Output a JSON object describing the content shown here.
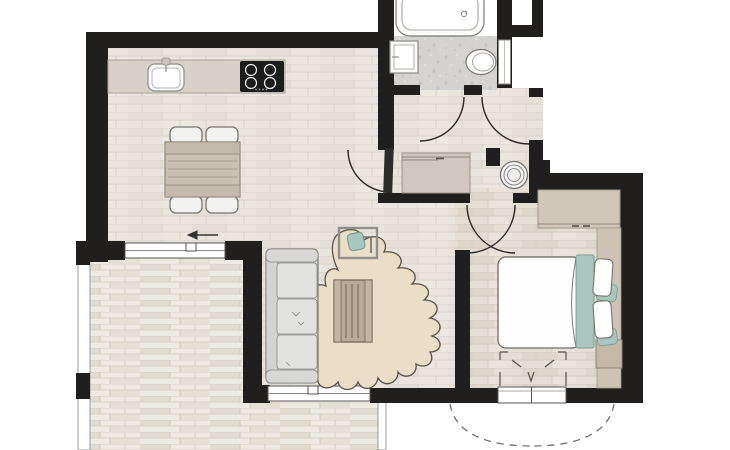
{
  "canvas": {
    "width": 730,
    "height": 450,
    "background": "#ffffff"
  },
  "colors": {
    "wall": "#211f1d",
    "floor_wood_main": "#e9e5de",
    "floor_wood_bedroom": "#e4ded4",
    "floor_balcony": "#edeae3",
    "floor_tile_bath": "#d4d3d1",
    "counter": "#d8d1c8",
    "closet": "#d0c8be",
    "wardrobe": "#d0c7ba",
    "side_panel": "#cdc3b5",
    "bench": "#c4b9a9",
    "dining_table": "#c9c0b4",
    "coffee_table": "#b9ab94",
    "rug": "#eadfc6",
    "sofa": "#dddddc",
    "sofa_cushion": "#e1e1df",
    "teal_accent": "#a9c6bf",
    "bed_duvet": "#fdfdfd",
    "fixture_white": "#fbfbfa",
    "outline": "#77756f",
    "arrow": "#333333",
    "dash": "#666666"
  },
  "rooms": [
    {
      "name": "kitchen-dining",
      "floor": "wood",
      "furniture": [
        "kitchen-counter",
        "kitchen-sink",
        "cooktop-4-burner",
        "dining-table",
        "4-chairs",
        "direction-arrow-left"
      ]
    },
    {
      "name": "living-room",
      "floor": "wood",
      "furniture": [
        "sofa-3-seat",
        "area-rug-organic",
        "coffee-table-slatted",
        "desk-with-teal-seat",
        "direction-arrow-left"
      ]
    },
    {
      "name": "bathroom",
      "floor": "grey-tile",
      "furniture": [
        "bathtub",
        "wash-basin",
        "toilet",
        "wall-window"
      ]
    },
    {
      "name": "hallway",
      "floor": "wood",
      "furniture": [
        "sliding-door-closet",
        "washing-machine"
      ]
    },
    {
      "name": "bedroom",
      "floor": "wood",
      "furniture": [
        "double-bed",
        "teal-runner",
        "pillows",
        "wardrobe",
        "side-panel",
        "bench",
        "french-door-dashes"
      ]
    },
    {
      "name": "balcony",
      "floor": "deck-planks",
      "furniture": [
        "railing"
      ]
    }
  ],
  "doors": [
    {
      "name": "bathroom-door",
      "type": "swing"
    },
    {
      "name": "entrance-door",
      "type": "swing"
    },
    {
      "name": "living-room-door",
      "type": "swing-with-leaf"
    },
    {
      "name": "bedroom-door",
      "type": "double-arc"
    },
    {
      "name": "french-door",
      "type": "double-outward-dashed"
    }
  ],
  "windows": [
    {
      "name": "dining-window"
    },
    {
      "name": "living-window"
    },
    {
      "name": "bath-window"
    },
    {
      "name": "bedroom-french-door"
    }
  ],
  "arrows": [
    {
      "name": "dining-arrow",
      "direction": "left"
    },
    {
      "name": "living-arrow",
      "direction": "left"
    }
  ]
}
